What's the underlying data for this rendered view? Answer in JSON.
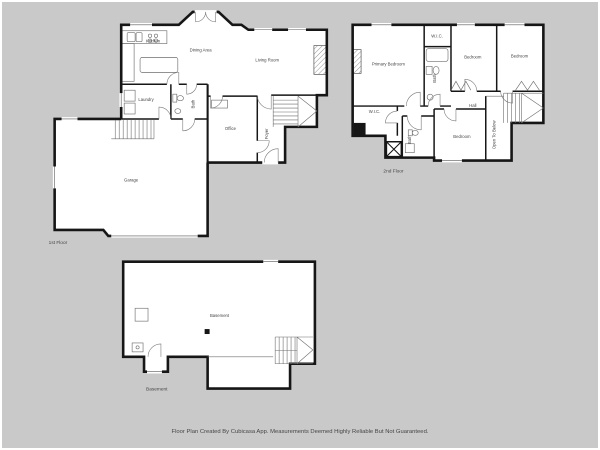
{
  "app": {
    "disclaimer": "Floor Plan Created By Cubicasa App. Measurements Deemed Highly Reliable But Not Guaranteed."
  },
  "colors": {
    "background": "#c9c9c9",
    "wall": "#161616",
    "floor": "#ffffff",
    "label": "#454545"
  },
  "floors": [
    {
      "label": "1st Floor",
      "rooms": [
        {
          "name": "Kitchen",
          "x": 152,
          "y": 41
        },
        {
          "name": "Dining Area",
          "x": 200,
          "y": 50
        },
        {
          "name": "Living Room",
          "x": 267,
          "y": 60
        },
        {
          "name": "Laundry",
          "x": 145,
          "y": 100
        },
        {
          "name": "Bath",
          "x": 194,
          "y": 103,
          "rotate": -90
        },
        {
          "name": "Office",
          "x": 230,
          "y": 129
        },
        {
          "name": "Foyer",
          "x": 268,
          "y": 133,
          "rotate": -90
        },
        {
          "name": "Garage",
          "x": 130,
          "y": 181
        }
      ]
    },
    {
      "label": "2nd Floor",
      "rooms": [
        {
          "name": "Primary Bedroom",
          "x": 389,
          "y": 64
        },
        {
          "name": "W.I.C.",
          "x": 438,
          "y": 36
        },
        {
          "name": "Bath",
          "x": 437,
          "y": 77,
          "rotate": -90
        },
        {
          "name": "Bedroom",
          "x": 474,
          "y": 57
        },
        {
          "name": "Bedroom",
          "x": 521,
          "y": 56
        },
        {
          "name": "Hall",
          "x": 474,
          "y": 106
        },
        {
          "name": "W.I.C.",
          "x": 375,
          "y": 112
        },
        {
          "name": "Bath",
          "x": 412,
          "y": 139,
          "rotate": -90
        },
        {
          "name": "Bedroom",
          "x": 463,
          "y": 137
        },
        {
          "name": "Open To Below",
          "x": 497,
          "y": 134,
          "rotate": -90
        }
      ]
    },
    {
      "label": "Basement",
      "rooms": [
        {
          "name": "Basement",
          "x": 219,
          "y": 318
        }
      ]
    }
  ]
}
